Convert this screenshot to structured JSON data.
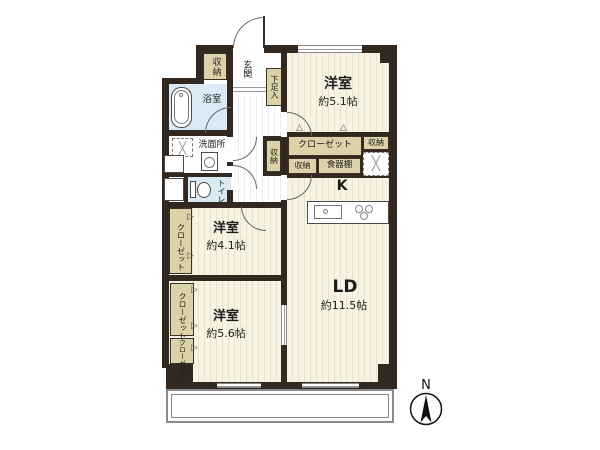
{
  "rooms": {
    "western1": {
      "name": "洋室",
      "size": "約5.1帖"
    },
    "western2": {
      "name": "洋室",
      "size": "約4.1帖"
    },
    "western3": {
      "name": "洋室",
      "size": "約5.6帖"
    },
    "living_dining": {
      "name": "LD",
      "size": "約11.5帖"
    },
    "kitchen": {
      "name": "K"
    },
    "bath": {
      "name": "浴室"
    },
    "washroom": {
      "name": "洗面所"
    },
    "toilet": {
      "name": "トイレ"
    },
    "entrance": {
      "name": "玄関"
    },
    "balcony": {
      "name": "バルコニー"
    }
  },
  "storage": {
    "entrance_storage": "収納",
    "shoe_cabinet": "下足入",
    "hall_storage": "収納",
    "main_closet": "クローゼット",
    "storage_top_right": "収納",
    "kitchen_storage": "収納",
    "cupboard": "食器棚",
    "closet_west2": "クローゼット",
    "closet_west3_upper": "クローゼット",
    "closet_west3_lower": "クローゼット"
  },
  "compass": {
    "north": "N"
  },
  "symbols": {
    "swing_right": "▷",
    "swing_up": "△",
    "equipment_cross": "╳"
  },
  "colors": {
    "wall": "#32281f",
    "floor_base": "#f8f3e2",
    "storage_fill": "#dcd2a8",
    "wet_area_fill": "#d9eaf5",
    "balcony_line": "#8a8a8a"
  }
}
